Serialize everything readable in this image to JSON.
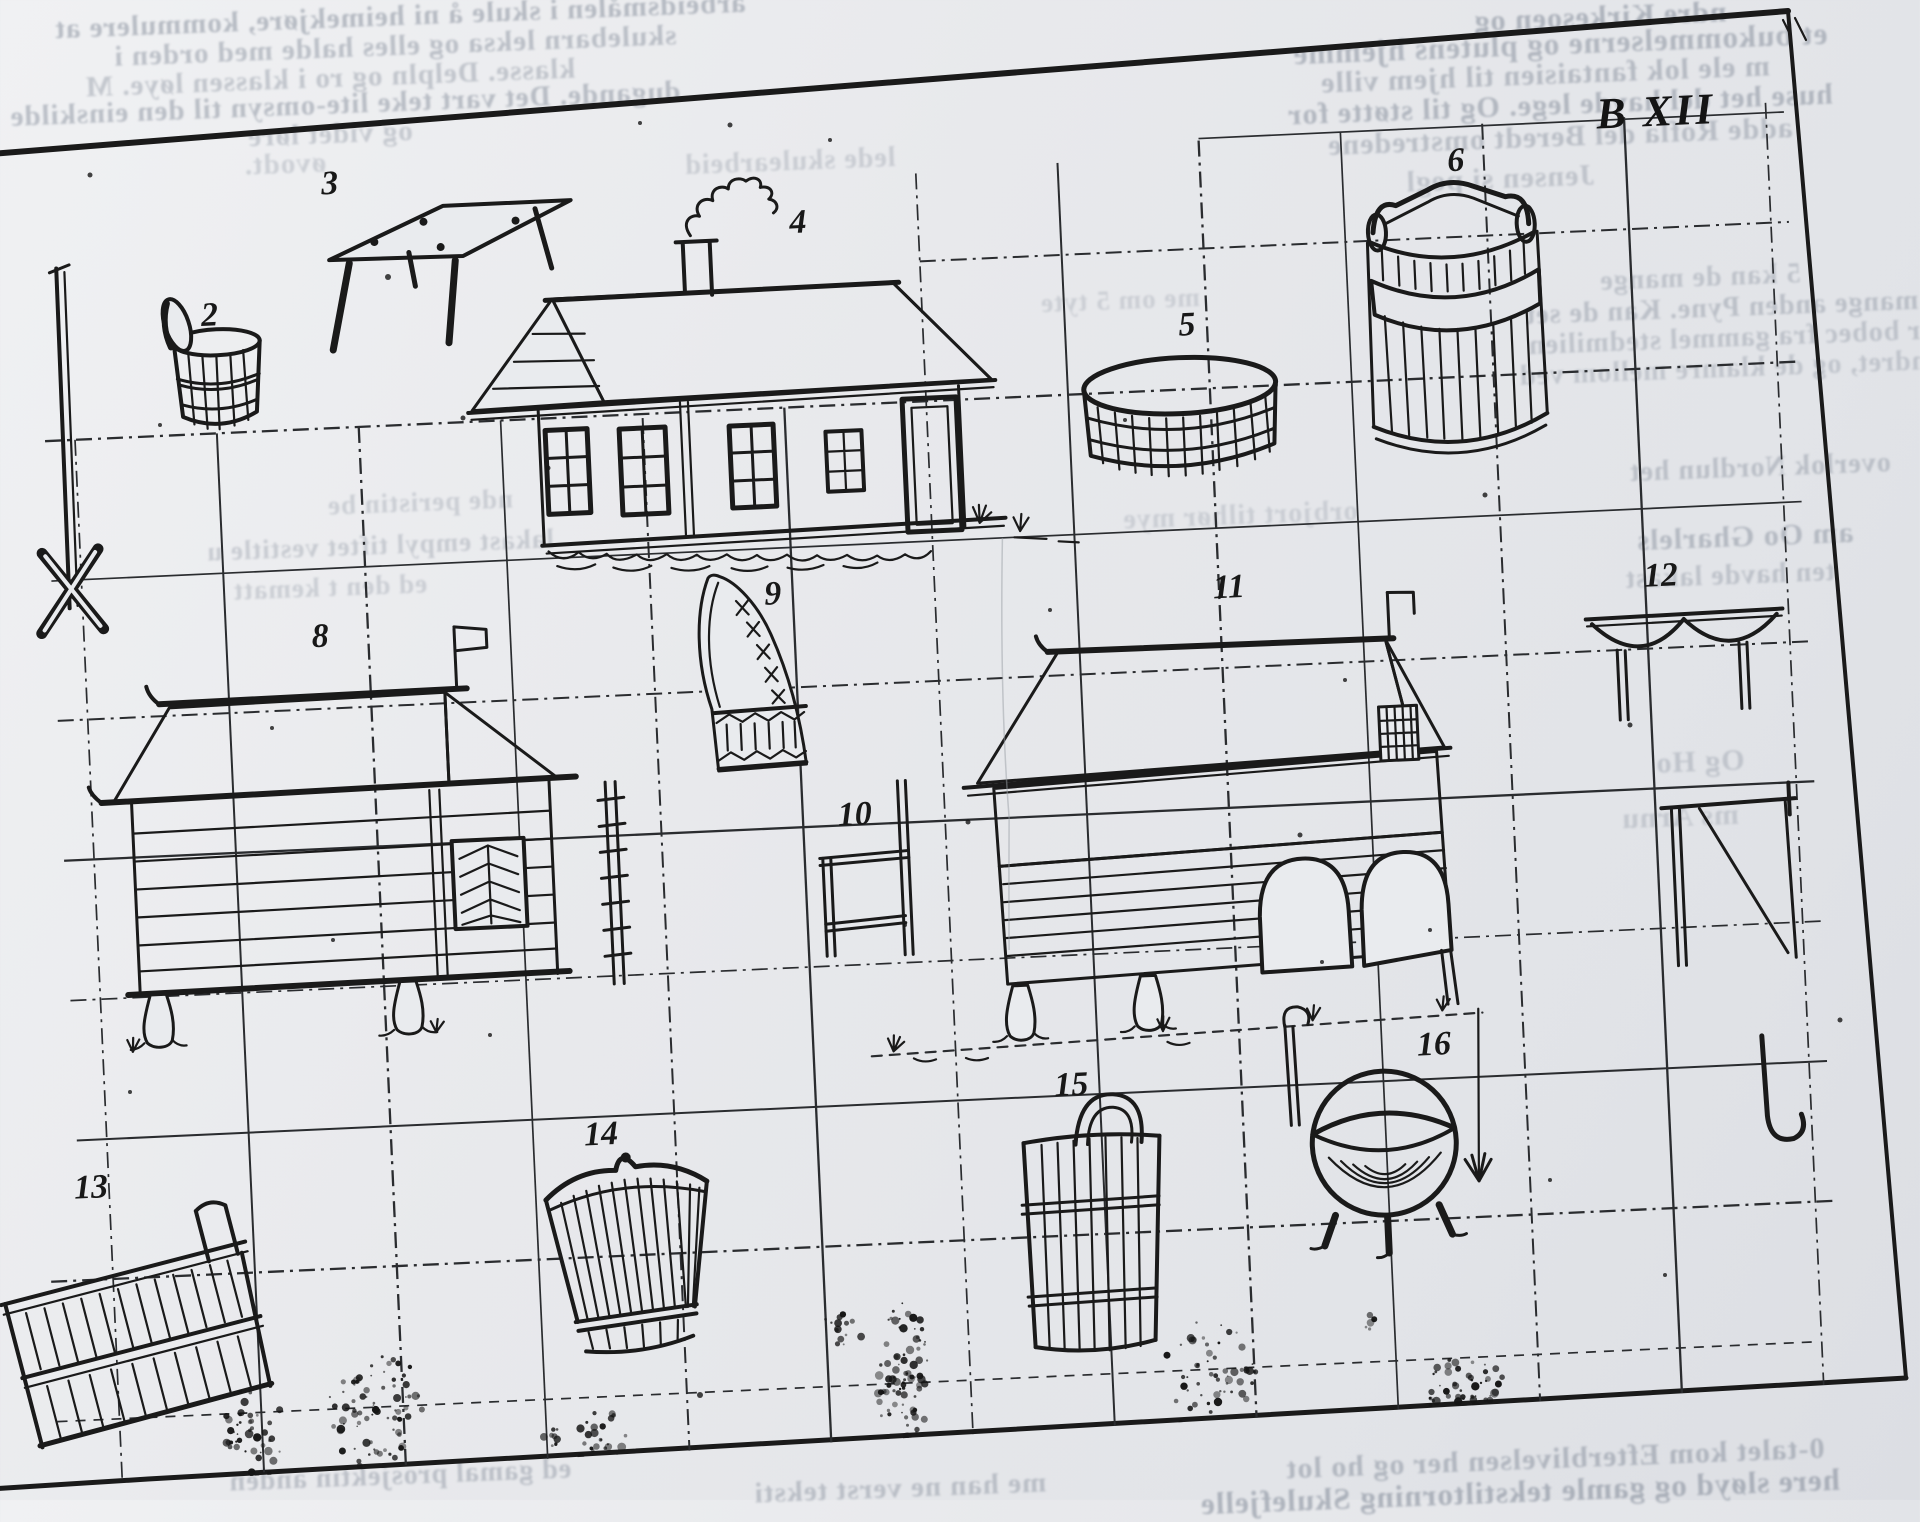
{
  "plate": {
    "label": "B XII"
  },
  "figures": [
    {
      "num": "2",
      "name": "lidded-stave-tub"
    },
    {
      "num": "3",
      "name": "wooden-trestle"
    },
    {
      "num": "4",
      "name": "farmhouse-with-chimney"
    },
    {
      "num": "5",
      "name": "low-round-vat"
    },
    {
      "num": "6",
      "name": "large-stave-barrel-with-lid"
    },
    {
      "num": "8",
      "name": "log-storehouse"
    },
    {
      "num": "9",
      "name": "curved-sled-runner"
    },
    {
      "num": "10",
      "name": "post-frame-gate"
    },
    {
      "num": "11",
      "name": "stave-barn-on-posts"
    },
    {
      "num": "12",
      "name": "scalloped-bench"
    },
    {
      "num": "13",
      "name": "tilted-stave-trough"
    },
    {
      "num": "14",
      "name": "woven-basket"
    },
    {
      "num": "15",
      "name": "stave-barrel-with-hoop-handle"
    },
    {
      "num": "16",
      "name": "three-legged-cauldron"
    }
  ],
  "bleed_text": {
    "mirrored": true,
    "fragments": [
      "arbeidsmålen i skule å ni heimekjøre, kommulere at",
      "skulebarn leksa og elles halde med orden i",
      "klasse. Delpln og ro i klassen løye. M",
      "dugande. Det vart teke lite-omsyn til den einskilde",
      "og videt løre",
      "øvodt.",
      "ndre Kirkesoen og",
      "et bukommelserne og plutens hjemme",
      "m ele lok fantaisien til hjem ville",
      "huse het del havde lege. Og til støtte for",
      "adde Rofla del Beredt omstredene",
      "Jensen si pegl",
      "5 kan de mange",
      "i mange anden Pyne. Kan de set",
      "har bobec fra gammel stedmilien",
      "forandret, og de klamre mellom ved",
      "overlok Nordlun het",
      "am Oo Gharlels",
      "ten havde lakast",
      "nde peristin be",
      "lakast empyl tiftet vestitle u",
      "ed den t kematt",
      "Og Ho",
      "ms Arnu",
      "0-talet kom Efterblivelsen her og ho lot",
      "here sløyd og gamle tekstiltorning Skulefjelle",
      "ed gamal prosjektin anden",
      "lede skulearbeid",
      "me om 5 tyte",
      "orbjort tilhør mye",
      "me han ne verst teksti"
    ]
  }
}
